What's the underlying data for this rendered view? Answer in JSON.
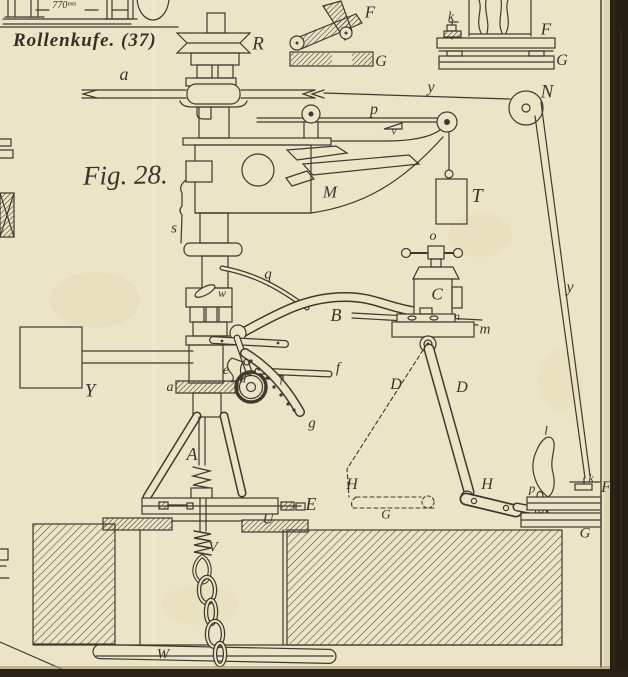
{
  "page": {
    "caption": "Rollenkufe. (37)",
    "figure_label": "Fig. 28."
  },
  "colors": {
    "paper": "#ece4c7",
    "ink": "#3e392e",
    "page_edge_dark": "#251e13",
    "bottom_edge_dark": "#2a2214"
  },
  "part_labels": [
    {
      "name": "dim-770",
      "text": "770ᵐᵐ",
      "x": 64,
      "y": 6,
      "size": 10
    },
    {
      "name": "roller-r",
      "text": "R",
      "x": 258,
      "y": 44,
      "size": 19
    },
    {
      "name": "shaft-a",
      "text": "a",
      "x": 124,
      "y": 74,
      "size": 18
    },
    {
      "name": "rope-y-top",
      "text": "y",
      "x": 431,
      "y": 88,
      "size": 16
    },
    {
      "name": "pulley-n",
      "text": "N",
      "x": 547,
      "y": 92,
      "size": 19
    },
    {
      "name": "rod-p",
      "text": "p",
      "x": 374,
      "y": 110,
      "size": 16
    },
    {
      "name": "rod-v",
      "text": "v",
      "x": 394,
      "y": 132,
      "size": 11
    },
    {
      "name": "arm-m",
      "text": "M",
      "x": 330,
      "y": 192,
      "size": 17
    },
    {
      "name": "rod-s",
      "text": "s",
      "x": 174,
      "y": 229,
      "size": 15
    },
    {
      "name": "weight-t",
      "text": "T",
      "x": 477,
      "y": 196,
      "size": 20
    },
    {
      "name": "inset1-f",
      "text": "F",
      "x": 370,
      "y": 12,
      "size": 17
    },
    {
      "name": "inset1-g",
      "text": "G",
      "x": 381,
      "y": 62,
      "size": 16
    },
    {
      "name": "inset2-k",
      "text": "k",
      "x": 451,
      "y": 18,
      "size": 14
    },
    {
      "name": "inset2-f",
      "text": "F",
      "x": 546,
      "y": 29,
      "size": 17
    },
    {
      "name": "inset2-g",
      "text": "G",
      "x": 562,
      "y": 61,
      "size": 16
    },
    {
      "name": "vise-o",
      "text": "o",
      "x": 433,
      "y": 237,
      "size": 14
    },
    {
      "name": "spring-q",
      "text": "q",
      "x": 268,
      "y": 275,
      "size": 15
    },
    {
      "name": "arm-b",
      "text": "B",
      "x": 336,
      "y": 315,
      "size": 18
    },
    {
      "name": "vise-c",
      "text": "C",
      "x": 437,
      "y": 294,
      "size": 17
    },
    {
      "name": "plate-n",
      "text": "n",
      "x": 457,
      "y": 316,
      "size": 12
    },
    {
      "name": "table-m",
      "text": "m",
      "x": 485,
      "y": 330,
      "size": 15
    },
    {
      "name": "stay-d-dashed",
      "text": "D",
      "x": 396,
      "y": 385,
      "size": 16
    },
    {
      "name": "stay-d",
      "text": "D",
      "x": 462,
      "y": 388,
      "size": 16
    },
    {
      "name": "box-y",
      "text": "Y",
      "x": 90,
      "y": 391,
      "size": 19
    },
    {
      "name": "handle-w",
      "text": "w",
      "x": 222,
      "y": 293,
      "size": 12
    },
    {
      "name": "pawl-e",
      "text": "e",
      "x": 226,
      "y": 371,
      "size": 14
    },
    {
      "name": "ratchet-d",
      "text": "d",
      "x": 243,
      "y": 378,
      "size": 13
    },
    {
      "name": "pin-i",
      "text": "i",
      "x": 281,
      "y": 382,
      "size": 11
    },
    {
      "name": "lever-f",
      "text": "f",
      "x": 338,
      "y": 369,
      "size": 15
    },
    {
      "name": "quadrant-g",
      "text": "g",
      "x": 312,
      "y": 424,
      "size": 15
    },
    {
      "name": "clamp-a",
      "text": "a",
      "x": 170,
      "y": 388,
      "size": 14
    },
    {
      "name": "frame-a-tripod",
      "text": "A",
      "x": 192,
      "y": 454,
      "size": 18
    },
    {
      "name": "bar-e",
      "text": "E",
      "x": 311,
      "y": 504,
      "size": 18
    },
    {
      "name": "plate-u",
      "text": "U",
      "x": 268,
      "y": 520,
      "size": 15
    },
    {
      "name": "screw-v",
      "text": "V",
      "x": 213,
      "y": 548,
      "size": 15
    },
    {
      "name": "bar-w",
      "text": "W",
      "x": 163,
      "y": 655,
      "size": 15
    },
    {
      "name": "link-h-dashed",
      "text": "H",
      "x": 352,
      "y": 485,
      "size": 16
    },
    {
      "name": "bar-g-dashed",
      "text": "G",
      "x": 386,
      "y": 514,
      "size": 13
    },
    {
      "name": "link-h",
      "text": "H",
      "x": 487,
      "y": 485,
      "size": 16
    },
    {
      "name": "pivot-p",
      "text": "p",
      "x": 532,
      "y": 488,
      "size": 13
    },
    {
      "name": "pedal-l",
      "text": "l",
      "x": 546,
      "y": 430,
      "size": 13
    },
    {
      "name": "pedal-k",
      "text": "k",
      "x": 591,
      "y": 478,
      "size": 12
    },
    {
      "name": "pedal-f",
      "text": "F",
      "x": 606,
      "y": 488,
      "size": 16
    },
    {
      "name": "pedal-g",
      "text": "G",
      "x": 585,
      "y": 534,
      "size": 15
    },
    {
      "name": "rope-y",
      "text": "y",
      "x": 570,
      "y": 288,
      "size": 16
    }
  ]
}
